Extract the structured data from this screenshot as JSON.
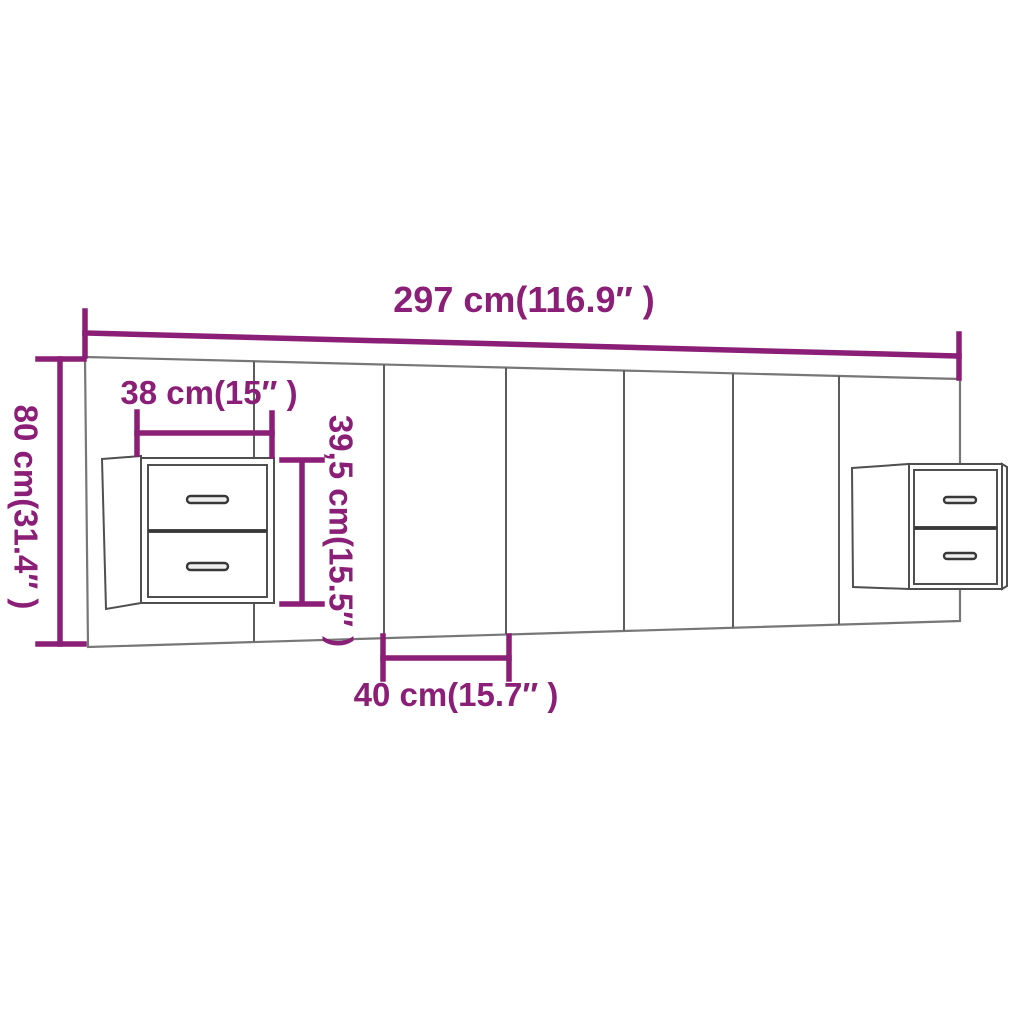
{
  "diagram": {
    "kind": "product-dimension-diagram",
    "measurements": [
      {
        "id": "total_width",
        "label": "297 cm(116.9″ )",
        "cm": "297",
        "inches": "116.9"
      },
      {
        "id": "height",
        "label": "80 cm(31.4″ )",
        "cm": "80",
        "inches": "31.4"
      },
      {
        "id": "cabinet_width",
        "label": "38 cm(15″ )",
        "cm": "38",
        "inches": "15"
      },
      {
        "id": "cabinet_height",
        "label": "39,5 cm(15.5″ )",
        "cm": "39,5",
        "inches": "15.5"
      },
      {
        "id": "panel_width",
        "label": "40 cm(15.7″ )",
        "cm": "40",
        "inches": "15.7"
      }
    ],
    "colors": {
      "accent": "#8b1e76",
      "outline": "#777777",
      "divider": "#5c5c5c",
      "cabinet_line": "#4f4f4f",
      "handle": "#383838",
      "background": "#ffffff"
    }
  }
}
